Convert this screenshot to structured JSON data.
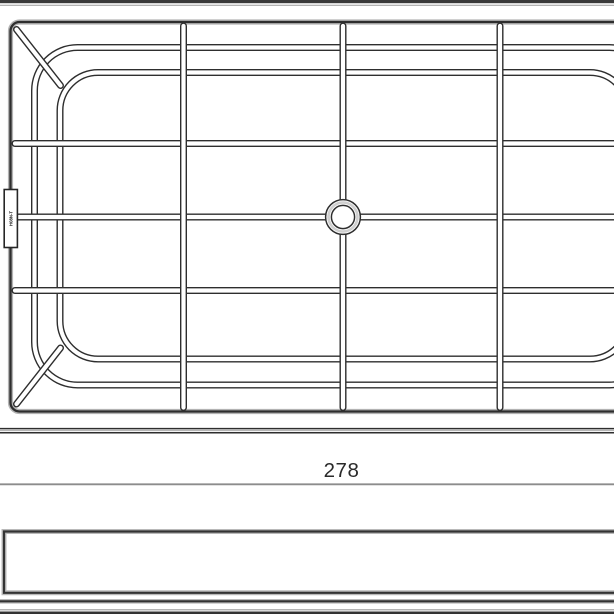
{
  "drawing": {
    "type": "technical-line-drawing",
    "subject": "pan-support-grid",
    "dimension_width_label": "278",
    "side_tab_text": "H08N-T",
    "colors": {
      "line_dark": "#2e2e2e",
      "line_halo": "#b3b3b3",
      "dimension_gray": "#8c8c8c",
      "background": "#ffffff"
    }
  }
}
